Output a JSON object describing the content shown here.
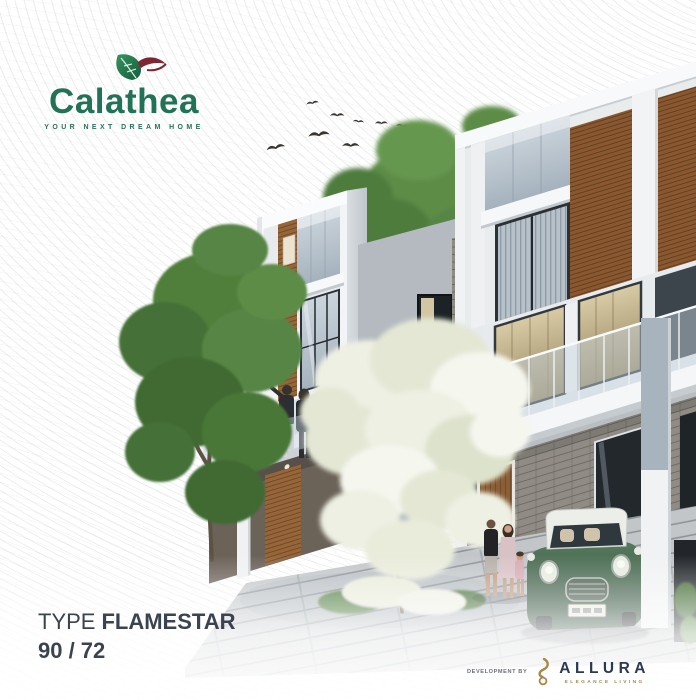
{
  "poster": {
    "brand": {
      "name": "Calathea",
      "tagline": "YOUR NEXT DREAM HOME",
      "logo_icon": "calathea-leaf-icon",
      "green": "#217257",
      "maroon": "#7c2733"
    },
    "unit": {
      "type_prefix": "TYPE",
      "type_name": "FLAMESTAR",
      "size": "90 / 72",
      "text_color": "#3b4250"
    },
    "developer": {
      "prefix": "DEVELOPMENT BY",
      "name": "ALLURA",
      "tagline": "ELEGANCE LIVING",
      "logo_icon": "allura-flame-icon",
      "navy": "#2d3852",
      "gold": "#a8874a"
    },
    "scene": {
      "description": "3D architectural render of modern three-storey townhouses with timber accent panels, glass balconies, stone-clad ground floor, a flowering white tree and green trees, a flock of birds, residents on a balcony and by the front door, and a green classic mini car with a white roof on the driveway",
      "birds_count": 8,
      "car_color": "#3f6450"
    }
  }
}
